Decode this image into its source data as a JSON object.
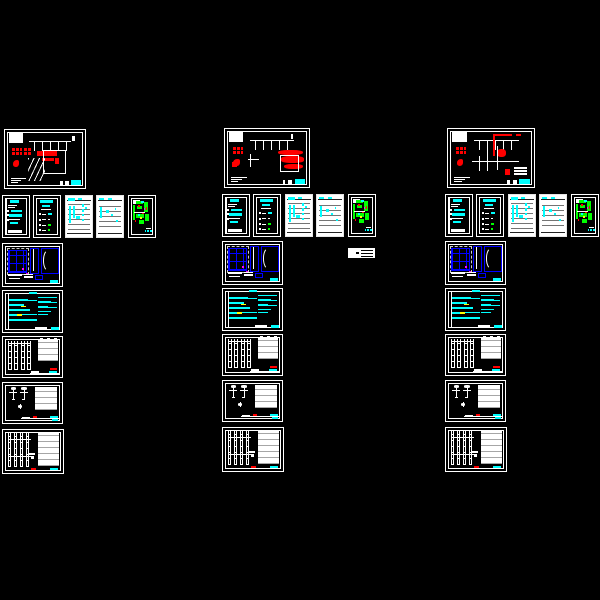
{
  "app": {
    "type": "cad-model-space",
    "background": "#000000",
    "description": "Black CAD model space showing three columns of drainage/plumbing drawing sheets"
  },
  "palette": {
    "line": "#ffffff",
    "paper": "#ffffff",
    "red": "#ff0000",
    "cyan": "#00ffff",
    "blue": "#0000ff",
    "green": "#00ff00",
    "yellow": "#ffff00",
    "magenta": "#ff00ff"
  },
  "groups": [
    {
      "name": "drawing-set-left",
      "x": 2,
      "dy": 1,
      "stack_dy": 2,
      "top_w": 82,
      "top_variant": "bars"
    },
    {
      "name": "drawing-set-middle",
      "x": 222,
      "dy": 0,
      "stack_dy": 0,
      "top_w": 86,
      "top_variant": "cloud"
    },
    {
      "name": "drawing-set-right",
      "x": 445,
      "dy": 0,
      "stack_dy": 0,
      "top_w": 88,
      "top_variant": "pipe"
    }
  ],
  "layout": {
    "top": {
      "x": 2,
      "y": 128,
      "h": 60,
      "type": "main-plan"
    },
    "row": {
      "y": 194,
      "h": 43,
      "w": 28,
      "offsets": [
        0,
        31,
        63,
        94,
        126
      ],
      "types": [
        "notes-dark",
        "legend-dark",
        "schedule-light",
        "schedule-light-2",
        "floor-plan-dark"
      ]
    },
    "stack": [
      {
        "x": 0,
        "y": 241,
        "w": 61,
        "h": 44,
        "type": "window-details"
      },
      {
        "x": 0,
        "y": 288,
        "w": 61,
        "h": 43,
        "type": "cyan-notes"
      },
      {
        "x": 0,
        "y": 334,
        "w": 61,
        "h": 42,
        "type": "riser-diagram"
      },
      {
        "x": 0,
        "y": 380,
        "w": 61,
        "h": 42,
        "type": "equipment-details"
      },
      {
        "x": 0,
        "y": 427,
        "w": 62,
        "h": 45,
        "type": "riser-diagram-2"
      }
    ]
  },
  "floating_block": {
    "x": 348,
    "y": 248,
    "w": 27,
    "h": 10
  }
}
